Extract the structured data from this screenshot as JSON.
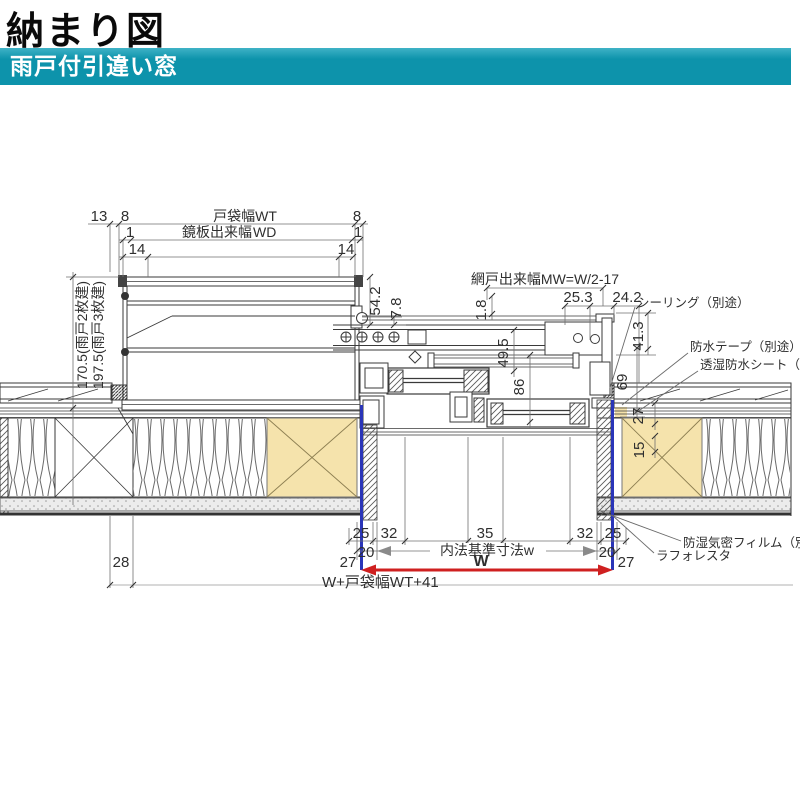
{
  "header": {
    "title": "納まり図",
    "subtitle": "雨戸付引違い窓"
  },
  "colors": {
    "band_teal": "#0d93ab",
    "accent_magenta": "#e8189e",
    "frame_blue": "#2a35b8",
    "dim_red": "#cf2020",
    "wood_tan": "#f5e3ac",
    "line_gray": "#3a3a3a"
  },
  "dims": {
    "top": {
      "d13": "13",
      "d8_left": "8",
      "d1_left": "1",
      "d14_left": "14",
      "pocket_width": "戸袋幅WT",
      "panel_label": "鏡板出来幅",
      "panel_value": "WD",
      "d8_right": "8",
      "d1_right": "1",
      "d14_right": "14"
    },
    "left": {
      "two_panel": "170.5(雨戸2枚建)",
      "three_panel": "197.5(雨戸3枚建)"
    },
    "upper": {
      "d54_2": "54.2",
      "d7_8": "7.8",
      "screen_width": "網戸出来幅MW=W/2-17",
      "d1_8": "1.8",
      "d49_5": "49.5",
      "d25_3": "25.3",
      "d24_2": "24.2"
    },
    "right": {
      "d41_3": "41.3",
      "d69": "69",
      "d27": "27",
      "d15": "15"
    },
    "center": {
      "d86": "86"
    },
    "bottom": {
      "d25_l": "25",
      "d32_l": "32",
      "d35": "35",
      "d32_r": "32",
      "d25_r": "25",
      "d20_l": "20",
      "inner_standard": "内法基準寸法w",
      "d20_r": "20",
      "d27_l": "27",
      "w": "W",
      "d27_r": "27",
      "total": "W+戸袋幅WT+41",
      "d28": "28"
    }
  },
  "notes": {
    "sealing": "シーリング（別途）",
    "waterproof_tape": "防水テープ（別途）",
    "breathable_sheet": "透湿防水シート（別途）",
    "vapor_film": "防湿気密フィルム（別途）",
    "product": "ラフォレスタ"
  }
}
